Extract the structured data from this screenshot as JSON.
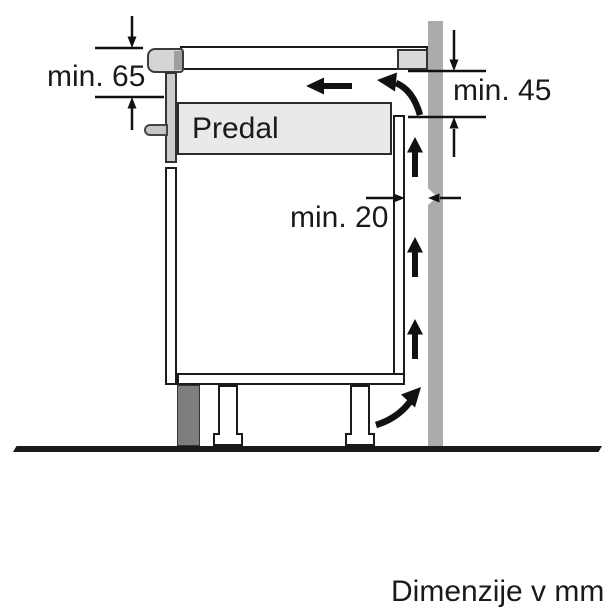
{
  "diagram": {
    "labels": {
      "drawer": "Predal",
      "dim_worktop_clearance": "min. 65",
      "dim_outlet_clearance": "min. 45",
      "dim_wall_gap": "min. 20",
      "units_note": "Dimenzije v mm"
    },
    "colors": {
      "background": "#ffffff",
      "line": "#1a1a1a",
      "arrow": "#111111",
      "wall": "#ababab",
      "plinth": "#7e7e7e",
      "drawer-fill": "#e9e9e9",
      "front-panel": "#cccccc",
      "hob": "#d5d5d5",
      "hob-dark": "#9f9f9f",
      "support": "#d9d9d9",
      "handle": "#c6c6c6"
    }
  }
}
